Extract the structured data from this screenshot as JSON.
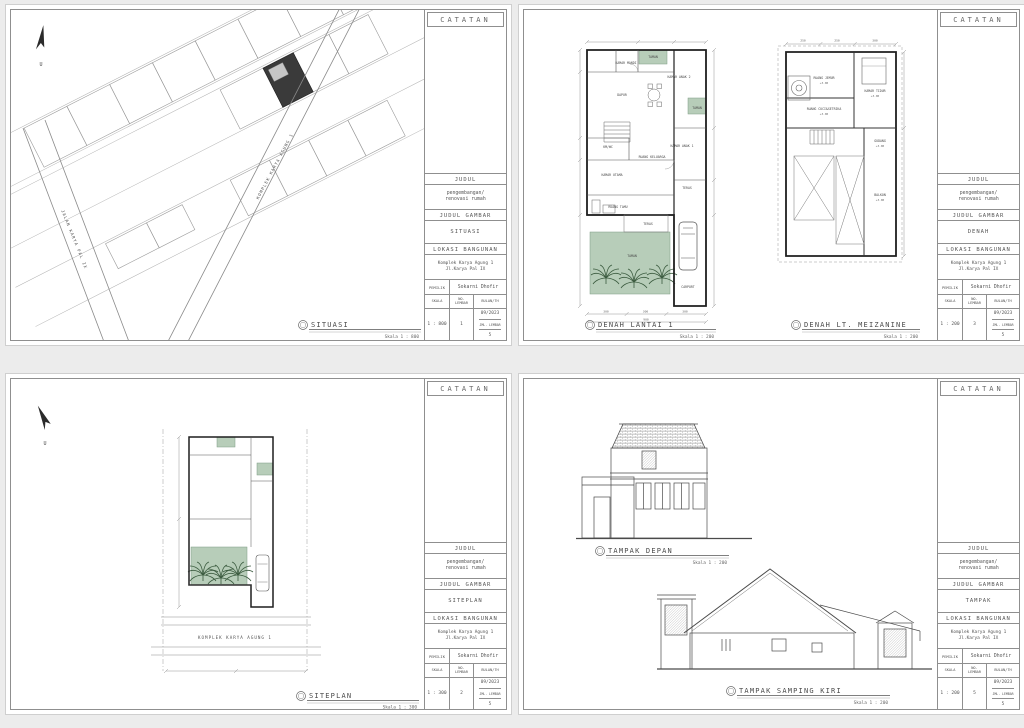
{
  "page": {
    "background": "#ececec"
  },
  "colors": {
    "taman_green": "#b7cdb9",
    "building_dark": "#3a3a3a",
    "line": "#555555"
  },
  "common": {
    "catatan": "CATATAN",
    "judul_label": "JUDUL",
    "judul": "pengembangan/\nrenovasi rumah",
    "judul_gambar_label": "JUDUL GAMBAR",
    "lokasi_label": "LOKASI BANGUNAN",
    "lokasi": "Komplek Karya Agung 1\nJl.Karya Pal IX",
    "pemilik_label": "PEMILIK",
    "pemilik": "Sokarni Dhofir",
    "skala_label": "SKALA",
    "no_lembar_label": "NO.\nLEMBAR",
    "bulan_label": "BULAN/TH",
    "bulan": "09/2023",
    "jml_label": "JML. LEMBAR",
    "jml": "5",
    "north": "U"
  },
  "sheets": {
    "situasi": {
      "gambar": "SITUASI",
      "skala": "1 : 800",
      "no": "1",
      "caption": {
        "title": "SITUASI",
        "scale": "Skala 1 : 800"
      },
      "road1": "KOMPLEK KARYA AGUNG 1",
      "road2": "JALAN KARYA PAL IX"
    },
    "denah": {
      "gambar": "DENAH",
      "skala": "1 : 200",
      "no": "3",
      "caption1": {
        "title": "DENAH LANTAI 1",
        "scale": "Skala 1 : 200"
      },
      "caption2": {
        "title": "DENAH LT. MEIZANINE",
        "scale": "Skala 1 : 200"
      },
      "lantai1_rooms": [
        "TAMAN",
        "KAMAR MANDI",
        "DAPUR",
        "KAMAR ANAK 2",
        "TAMAN",
        "KAMAR ANAK 1",
        "RUANG KELUARGA",
        "KM/WC",
        "KAMAR UTAMA",
        "RUANG TAMU",
        "TERAS",
        "TERAS",
        "TAMAN",
        "CARPORT"
      ],
      "mezz_rooms": [
        "RUANG JEMUR",
        "KAMAR TIDUR",
        "RUANG CUCI&SETRIKA",
        "GUDANG",
        "BALKON"
      ],
      "level": "+3.00",
      "dims_bottom": [
        "300",
        "300",
        "300",
        "900"
      ],
      "mezz_dims_top": [
        "250",
        "250",
        "300"
      ]
    },
    "siteplan": {
      "gambar": "SITEPLAN",
      "skala": "1 : 300",
      "no": "2",
      "caption": {
        "title": "SITEPLAN",
        "scale": "Skala 1 : 300"
      },
      "street": "KOMPLEK KARYA AGUNG 1"
    },
    "tampak": {
      "gambar": "TAMPAK",
      "skala": "1 : 200",
      "no": "5",
      "caption1": {
        "title": "TAMPAK DEPAN",
        "scale": "Skala 1 : 200"
      },
      "caption2": {
        "title": "TAMPAK SAMPING KIRI",
        "scale": "Skala 1 : 200"
      }
    }
  }
}
